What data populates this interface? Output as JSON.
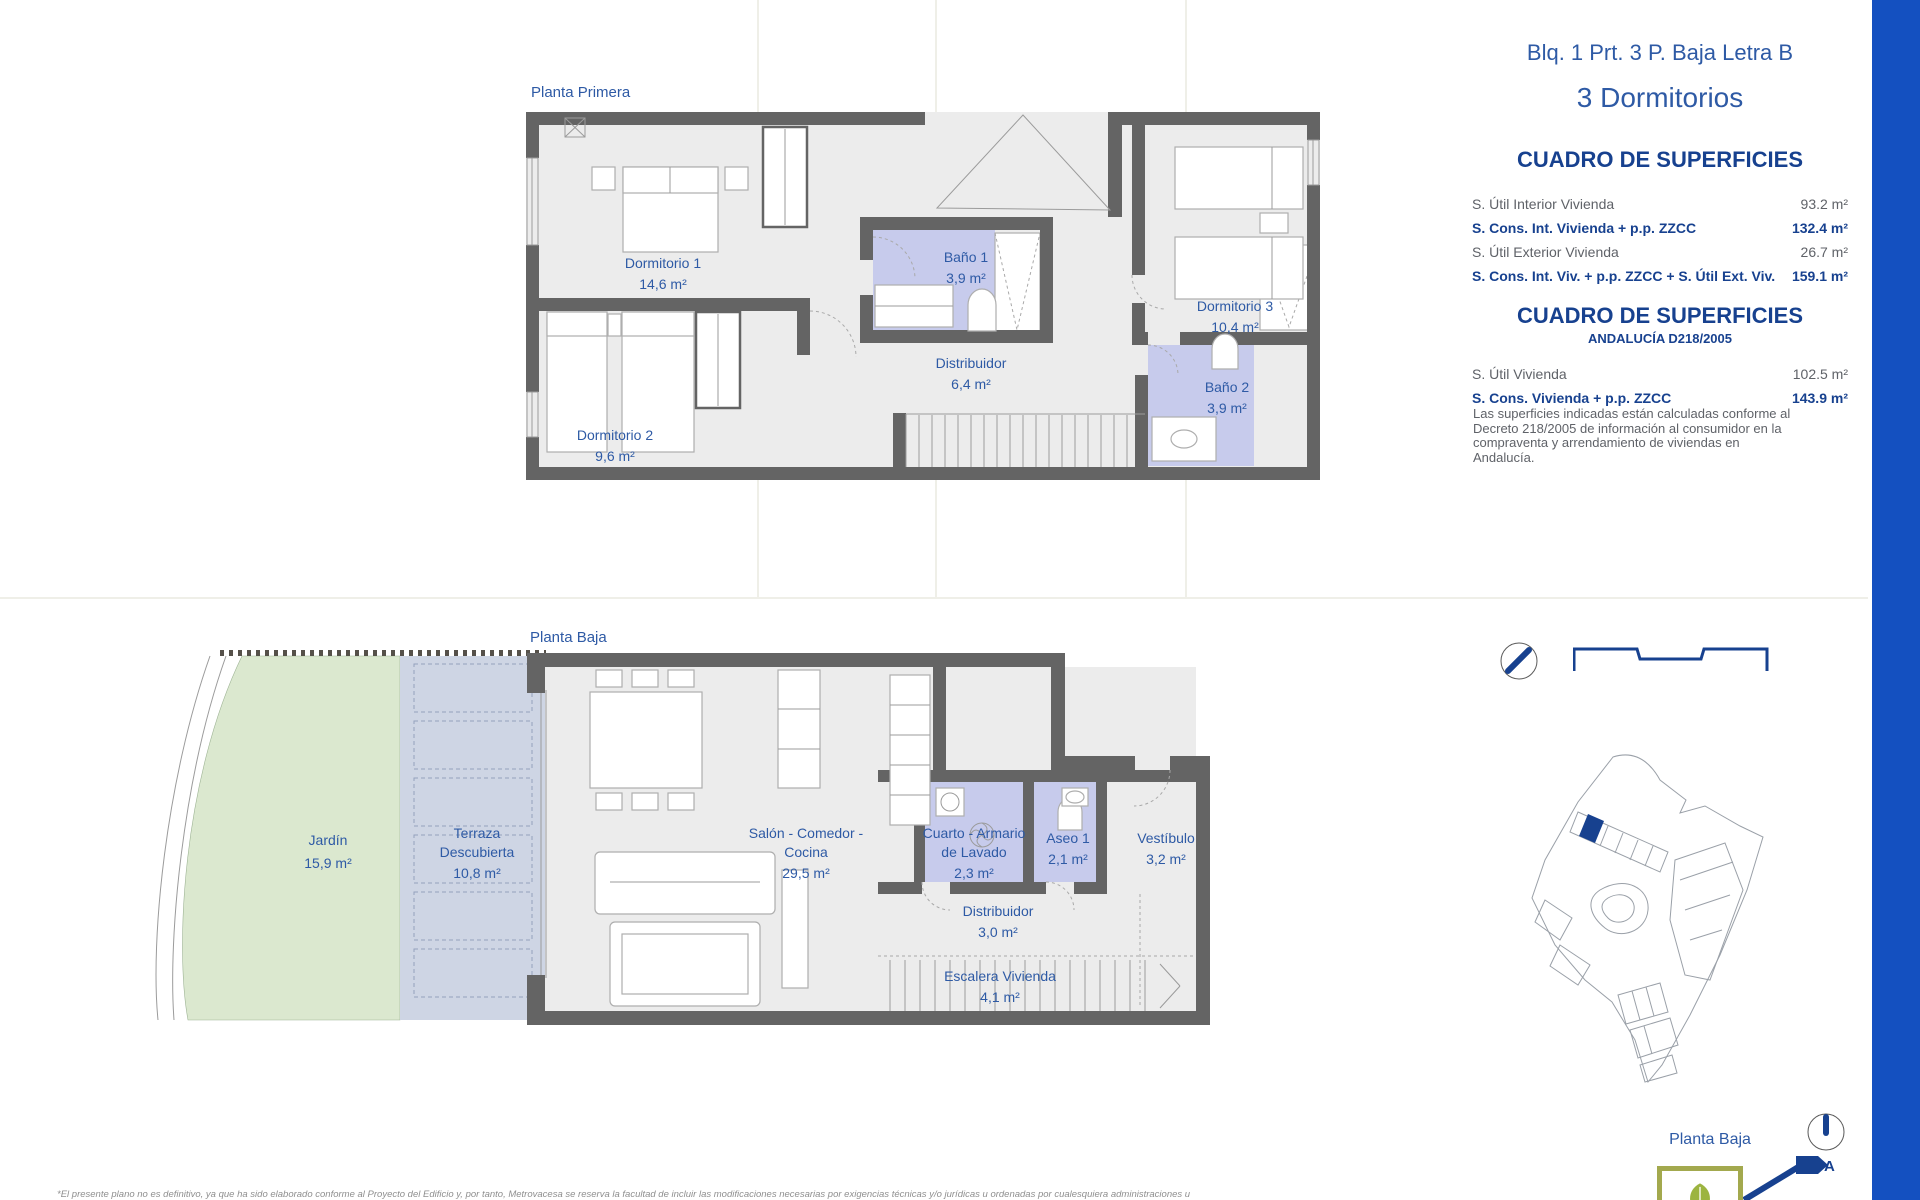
{
  "header": {
    "title": "Blq. 1 Prt. 3 P. Baja Letra B",
    "subtitle": "3 Dormitorios"
  },
  "table1": {
    "title": "CUADRO DE SUPERFICIES",
    "rows": [
      {
        "label": "S. Útil Interior Vivienda",
        "value": "93.2 m²"
      },
      {
        "label": "S. Cons. Int. Vivienda + p.p. ZZCC",
        "value": "132.4 m²"
      },
      {
        "label": "S. Útil Exterior Vivienda",
        "value": "26.7 m²"
      },
      {
        "label": "S. Cons. Int. Viv. + p.p. ZZCC + S. Útil Ext. Viv.",
        "value": "159.1 m²"
      }
    ]
  },
  "table2": {
    "title": "CUADRO DE SUPERFICIES",
    "subtitle": "ANDALUCÍA D218/2005",
    "rows": [
      {
        "label": "S. Útil Vivienda",
        "value": "102.5 m²"
      },
      {
        "label": "S. Cons. Vivienda + p.p. ZZCC",
        "value": "143.9 m²"
      }
    ],
    "note": "Las superficies indicadas están calculadas conforme al Decreto 218/2005 de información al consumidor en la compraventa y arrendamiento de viviendas en Andalucía."
  },
  "plans": {
    "first_floor": {
      "label": "Planta Primera",
      "rooms": [
        {
          "name": "Dormitorio 1",
          "area": "14,6 m²"
        },
        {
          "name": "Dormitorio 2",
          "area": "9,6 m²"
        },
        {
          "name": "Baño 1",
          "area": "3,9 m²"
        },
        {
          "name": "Distribuidor",
          "area": "6,4 m²"
        },
        {
          "name": "Dormitorio 3",
          "area": "10,4 m²"
        },
        {
          "name": "Baño 2",
          "area": "3,9 m²"
        }
      ]
    },
    "ground_floor": {
      "label": "Planta Baja",
      "rooms": [
        {
          "name": "Jardín",
          "area": "15,9 m²"
        },
        {
          "name": "Terraza Descubierta",
          "area": "10,8 m²"
        },
        {
          "name": "Salón - Comedor - Cocina",
          "area": "29,5 m²"
        },
        {
          "name": "Cuarto - Armario de Lavado",
          "area": "2,3 m²"
        },
        {
          "name": "Aseo 1",
          "area": "2,1 m²"
        },
        {
          "name": "Vestíbulo",
          "area": "3,2 m²"
        },
        {
          "name": "Distribuidor",
          "area": "3,0 m²"
        },
        {
          "name": "Escalera Vivienda",
          "area": "4,1 m²"
        }
      ]
    }
  },
  "site_plan": {
    "label": "Planta Baja"
  },
  "north": {
    "label": "A"
  },
  "footer": {
    "disclaimer": "*El presente plano no es definitivo, ya que ha sido elaborado conforme al Proyecto del Edificio y, por tanto, Metrovacesa se reserva la facultad de incluir las modificaciones necesarias por exigencias técnicas y/o jurídicas u ordenadas por cualesquiera administraciones u"
  },
  "colors": {
    "navy": "#17418f",
    "blue": "#2e5aa5",
    "bar": "#1450c0",
    "wall": "#646464",
    "floor": "#ececec",
    "lavender": "#c7cbec",
    "garden": "#dbe8cf",
    "terrace": "#ced5e4",
    "graytext": "#5f6268",
    "thin": "#9b9b9b",
    "furn": "#aeaeae"
  }
}
